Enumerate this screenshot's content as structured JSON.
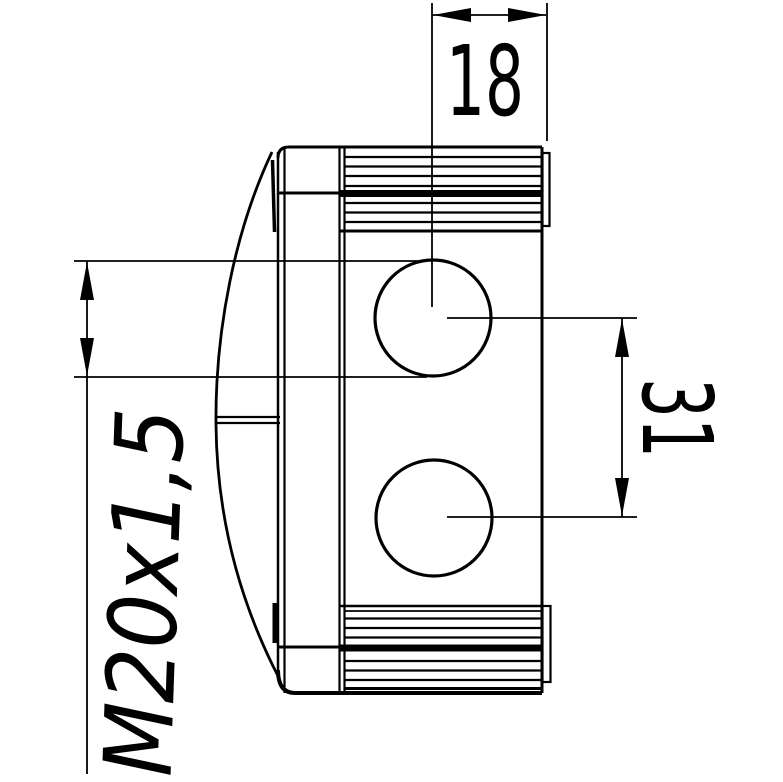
{
  "drawing": {
    "dimensions": {
      "top_width": "18",
      "hole_spacing": "31",
      "thread_size": "M20x1,5"
    },
    "colors": {
      "line": "#000000",
      "background": "#ffffff"
    }
  }
}
